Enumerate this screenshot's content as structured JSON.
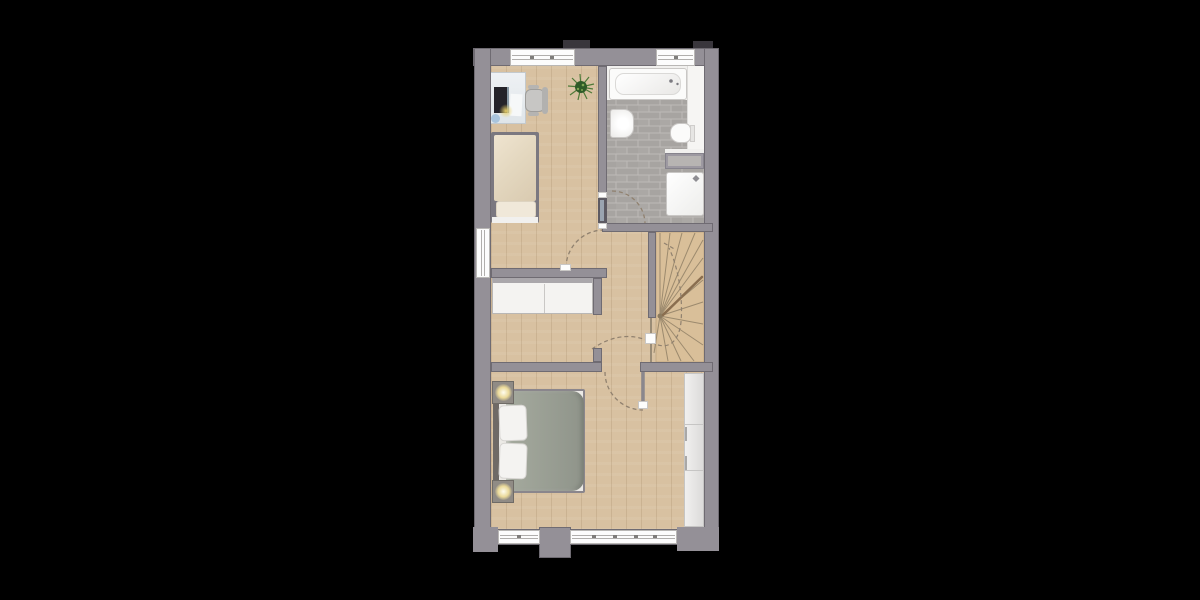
{
  "scene": {
    "type": "floor-plan-rendering",
    "description": "Top-down rendered floor plan of an upper storey on a black background",
    "text_visible": false
  },
  "palette": {
    "background": "#000000",
    "wall": "#949097",
    "wall_edge": "#6f6b72",
    "wall_dark": "#39363c",
    "wood": "#d8c1a1",
    "stair_wood": "#d9bf99",
    "stair_line": "#9c8a6e",
    "handrail": "#8a6e4f",
    "tile": "#a7a4a1",
    "tile_alt": "#aba8a5",
    "tile_grout": "#bdbab7",
    "fixture": "#fbfbfa",
    "fixture_border": "#c9c7c5",
    "glass": "#eef1f4",
    "monitor": "#24232a",
    "duvet_single_a": "#efe4d0",
    "duvet_single_b": "#d9cab0",
    "pillow_single": "#f0e8d9",
    "bedframe": "#7b7880",
    "duvet_a": "#a5aa9e",
    "duvet_b": "#8f948a",
    "pillow": "#f4f3f1",
    "headboard": "#6f6a66",
    "nightstand": "#908b85",
    "lamp_core": "#fffdf0",
    "lamp_mid": "#ead999",
    "wardrobe_a": "#f1f0ef",
    "wardrobe_b": "#dcdbda",
    "wardrobe_line": "#c6c5c4",
    "sideboard": "#f4f3f1",
    "sideboard_border": "#b9b7b5",
    "sideboard_top": "#aaa7ab",
    "window_white": "#fcfcfc",
    "window_line": "#b0aeac",
    "window_tick": "#7e7c7a",
    "arc": "#90816f",
    "door_leaf": "#5d5a62",
    "door_leaf_light": "#9aa4b0",
    "leaf_line": "#8a878d",
    "chair": "#c7c6c4",
    "chair_dark": "#9e9d9b",
    "shelf_dark": "#86838c",
    "shelf_mid": "#9d99a1",
    "shelf_light": "#b7b4b2",
    "blue_item": "#a9c4dc",
    "glow": "#e8d06a",
    "plant_dark": "#2f5b28",
    "plant_mid": "#4e7a38",
    "plant_light": "#7fa653"
  },
  "rooms": [
    {
      "id": "bedroom-small",
      "position": "top-left",
      "floor": "wood-planks",
      "furniture": [
        "desk-with-monitor",
        "desk-chair",
        "potted-plant",
        "single-bed"
      ],
      "openings": [
        "window-top",
        "window-left",
        "door-to-landing"
      ]
    },
    {
      "id": "bathroom",
      "position": "top-right",
      "floor": "grey-brick-tile",
      "fixtures": [
        "bathtub",
        "washbasin",
        "toilet",
        "vanity-shelf",
        "shower"
      ],
      "openings": [
        "window-top",
        "door-to-bedroom-small-side"
      ]
    },
    {
      "id": "landing",
      "position": "middle",
      "floor": "wood-planks",
      "furniture": [
        "sideboard"
      ],
      "features": [
        "walk-line-to-stairs"
      ]
    },
    {
      "id": "staircase",
      "position": "middle-right",
      "type": "winder-stair",
      "features": [
        "radial-treads",
        "handrail",
        "dashed-walk-line",
        "newel-marker"
      ]
    },
    {
      "id": "bedroom-master",
      "position": "bottom",
      "floor": "wood-planks",
      "furniture": [
        "double-bed",
        "nightstand-top",
        "nightstand-bottom",
        "wardrobe"
      ],
      "openings": [
        "window-bottom-left",
        "window-bottom-long",
        "door-to-landing"
      ]
    }
  ],
  "doors": [
    {
      "id": "door-bedroom-small",
      "style": "swing",
      "arc": "dashed"
    },
    {
      "id": "door-bathroom",
      "style": "swing-closed-leaf",
      "arc": "dashed"
    },
    {
      "id": "door-bedroom-master",
      "style": "swing-open-leaf",
      "arc": "dashed"
    }
  ],
  "windows": [
    {
      "id": "window-top-left",
      "wall": "north"
    },
    {
      "id": "window-top-right",
      "wall": "north"
    },
    {
      "id": "window-west",
      "wall": "west"
    },
    {
      "id": "window-south-small",
      "wall": "south"
    },
    {
      "id": "window-south-long",
      "wall": "south"
    }
  ]
}
